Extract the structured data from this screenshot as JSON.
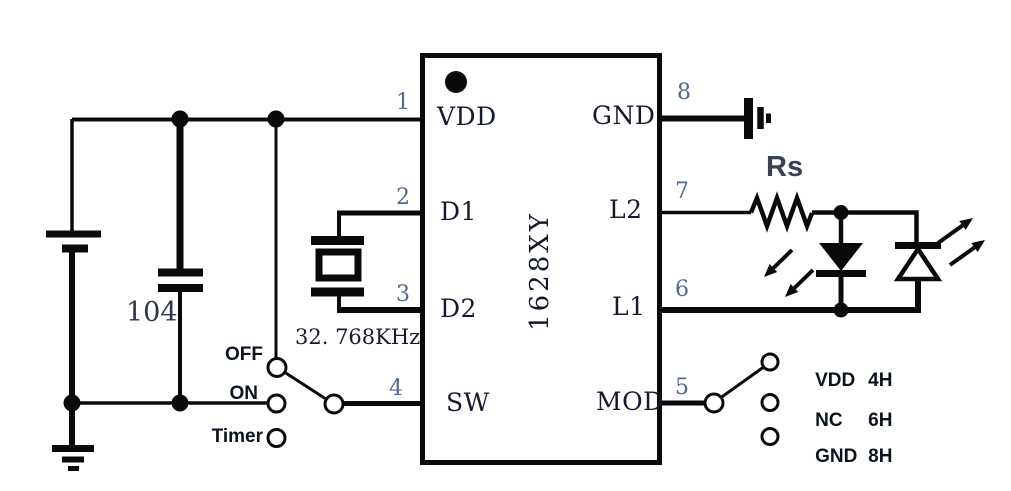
{
  "colors": {
    "ink": "#0a0a0a",
    "pin_number_text": "#54688f",
    "ic_text": "#15192e",
    "bold_label_text": "#0c1320",
    "rs_label_text": "#3a4150",
    "background": "#ffffff"
  },
  "ic": {
    "part_number": "YX8261",
    "pins": {
      "vdd": {
        "num": "1",
        "name": "VDD"
      },
      "d1": {
        "num": "2",
        "name": "D1"
      },
      "d2": {
        "num": "3",
        "name": "D2"
      },
      "sw": {
        "num": "4",
        "name": "SW"
      },
      "mod": {
        "num": "5",
        "name": "MOD"
      },
      "l1": {
        "num": "6",
        "name": "L1"
      },
      "l2": {
        "num": "7",
        "name": "L2"
      },
      "gnd": {
        "num": "8",
        "name": "GND"
      }
    }
  },
  "components": {
    "capacitor_value": "104",
    "crystal_frequency": "32. 768KHz",
    "series_resistor": "Rs"
  },
  "power_switch": {
    "off": "OFF",
    "on": "ON",
    "timer": "Timer"
  },
  "mode_switch": {
    "options": [
      {
        "name": "VDD",
        "duration": "4H"
      },
      {
        "name": "NC",
        "duration": "6H"
      },
      {
        "name": "GND",
        "duration": "8H"
      }
    ]
  }
}
